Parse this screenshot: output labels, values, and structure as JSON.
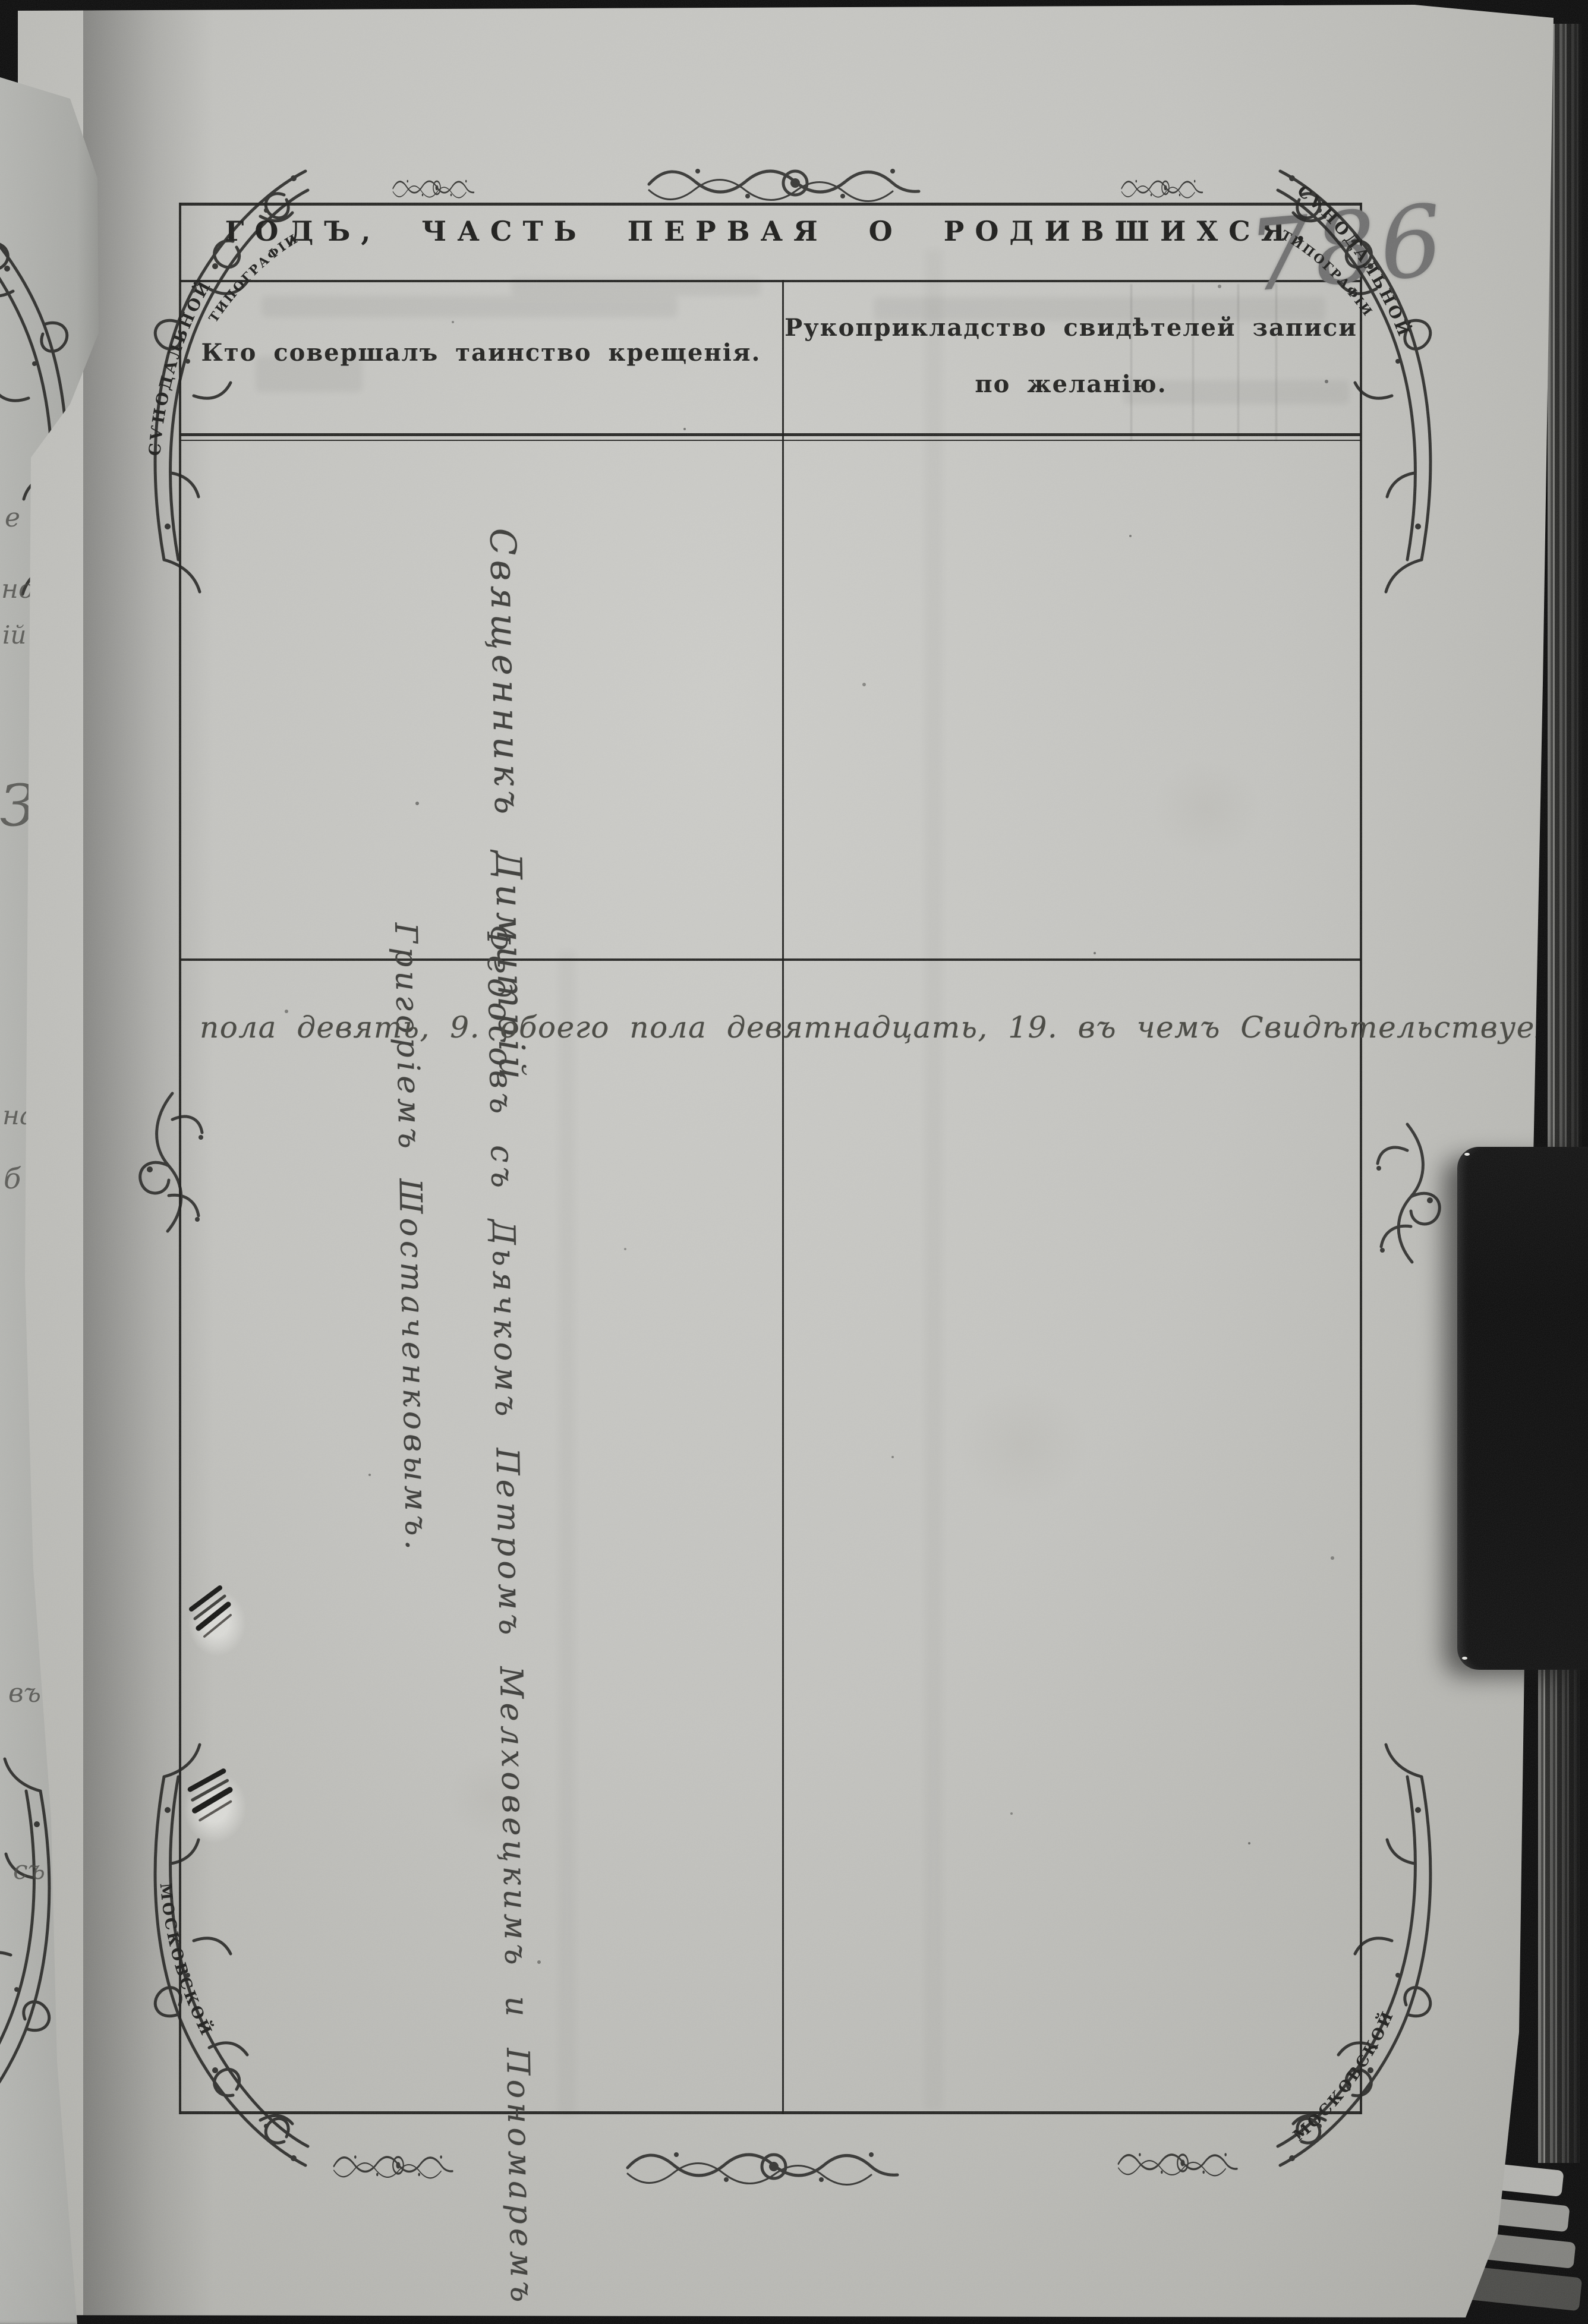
{
  "document": {
    "title": "ГОДЪ, ЧАСТЬ ПЕРВАЯ О РОДИВШИХСЯ.",
    "table": {
      "col1_header": "Кто совершалъ таинство крещенія.",
      "col2_header_line1": "Рукоприкладство свидѣтелей записи",
      "col2_header_line2": "по желанію."
    }
  },
  "handwriting": {
    "page_number_pencil": "786",
    "clergy_line1": "Священникъ Димитрій",
    "clergy_line2": "Федосовъ съ Дьячкомъ Петромъ Мелховецкимъ и Пономаремъ",
    "clergy_line3": "Григоріемъ Шостаченковымъ.",
    "totals_line": "пола девять, 9. обоего пола девятнадцать, 19. въ чемъ Свидѣтельствуемъ."
  },
  "ornaments": {
    "banner_synodal": "СѴНОДАЛЬНОЙ",
    "banner_tipografii": "ТИПОГРАФІИ",
    "banner_moskovskoy": "МОСКОВСКОЙ"
  },
  "neighbor_page_fragments": [
    "е",
    "но",
    "ій",
    "З",
    "на",
    "б",
    "въ",
    "съ"
  ],
  "palette": {
    "paper": "#c6c6c2",
    "ink": "#3b3b38",
    "print": "#1d1d1b",
    "pencil": "#6f6f6f",
    "background": "#0a0a0a"
  }
}
